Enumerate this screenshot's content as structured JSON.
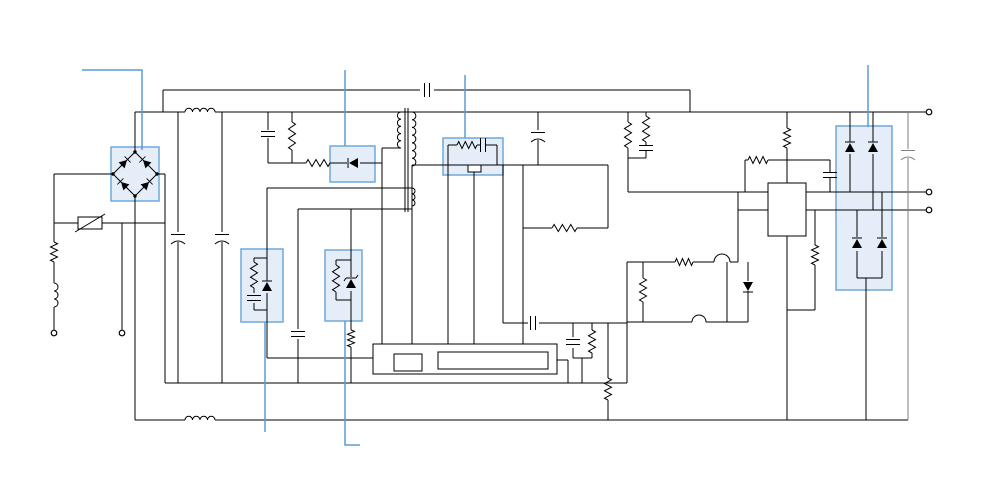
{
  "diagram": {
    "title": "switched-mode-power-supply-schematic",
    "canvas": {
      "width": 1000,
      "height": 500,
      "background": "#ffffff"
    },
    "colors": {
      "wire": "#000000",
      "highlight_fill": "#cfe0f2",
      "highlight_stroke": "#6fa8dc",
      "leader": "#5b9bd5",
      "secondary_wire": "#7f7f7f"
    },
    "highlights": [
      {
        "n": "bridge-rectifier-highlight",
        "x": 111,
        "y": 147,
        "w": 48,
        "h": 54
      },
      {
        "n": "clamp-diode-highlight",
        "x": 330,
        "y": 146,
        "w": 45,
        "h": 36
      },
      {
        "n": "shunt-network-1-highlight",
        "x": 241,
        "y": 249,
        "w": 42,
        "h": 73
      },
      {
        "n": "shunt-zener-highlight",
        "x": 325,
        "y": 250,
        "w": 37,
        "h": 71
      },
      {
        "n": "rc-clamp-highlight",
        "x": 443,
        "y": 138,
        "w": 60,
        "h": 37
      },
      {
        "n": "output-rectifier-highlight",
        "x": 836,
        "y": 126,
        "w": 56,
        "h": 164
      }
    ],
    "leaders": [
      {
        "n": "callout-bridge",
        "pts": [
          [
            82,
            70
          ],
          [
            142,
            70
          ],
          [
            142,
            150
          ]
        ]
      },
      {
        "n": "callout-clamp-diode",
        "pts": [
          [
            345,
            70
          ],
          [
            345,
            146
          ]
        ]
      },
      {
        "n": "callout-rc-clamp",
        "pts": [
          [
            465,
            75
          ],
          [
            465,
            138
          ]
        ]
      },
      {
        "n": "callout-output-rectifier",
        "pts": [
          [
            868,
            65
          ],
          [
            868,
            127
          ]
        ]
      },
      {
        "n": "callout-shunt-1",
        "pts": [
          [
            265,
            322
          ],
          [
            265,
            432
          ]
        ]
      },
      {
        "n": "callout-shunt-zener",
        "pts": [
          [
            345,
            321
          ],
          [
            345,
            445
          ],
          [
            360,
            445
          ]
        ]
      }
    ],
    "wires": [
      [
        163,
        90,
        420,
        90
      ],
      [
        434,
        90,
        690,
        90
      ],
      [
        163,
        90,
        163,
        112
      ],
      [
        690,
        90,
        690,
        112
      ],
      [
        135,
        112,
        185,
        112
      ],
      [
        215,
        112,
        926,
        112
      ],
      [
        135,
        112,
        135,
        152
      ],
      [
        135,
        196,
        135,
        420
      ],
      [
        113,
        174,
        54,
        174
      ],
      [
        54,
        174,
        54,
        242
      ],
      [
        54,
        262,
        54,
        283
      ],
      [
        54,
        307,
        54,
        330
      ],
      [
        157,
        174,
        165,
        174
      ],
      [
        165,
        174,
        165,
        383
      ],
      [
        54,
        223,
        78,
        223
      ],
      [
        102,
        223,
        165,
        223
      ],
      [
        122,
        223,
        122,
        330
      ],
      [
        165,
        383,
        627,
        383
      ],
      [
        135,
        420,
        185,
        420
      ],
      [
        215,
        420,
        908,
        420
      ],
      [
        178,
        112,
        178,
        232
      ],
      [
        178,
        242,
        178,
        383
      ],
      [
        222,
        112,
        222,
        232
      ],
      [
        222,
        242,
        222,
        383
      ],
      [
        268,
        112,
        268,
        130
      ],
      [
        268,
        138,
        268,
        163
      ],
      [
        292,
        112,
        292,
        122
      ],
      [
        292,
        150,
        292,
        163
      ],
      [
        268,
        163,
        292,
        163
      ],
      [
        292,
        163,
        306,
        163
      ],
      [
        330,
        163,
        347,
        163
      ],
      [
        360,
        163,
        382,
        163
      ],
      [
        382,
        148,
        382,
        344
      ],
      [
        382,
        148,
        401,
        148
      ],
      [
        412,
        188,
        267,
        188
      ],
      [
        412,
        206,
        412,
        209
      ],
      [
        298,
        209,
        412,
        209
      ],
      [
        267,
        188,
        267,
        281
      ],
      [
        267,
        293,
        267,
        322
      ],
      [
        267,
        322,
        267,
        358
      ],
      [
        267,
        358,
        373,
        358
      ],
      [
        267,
        258,
        254,
        258
      ],
      [
        254,
        258,
        254,
        262
      ],
      [
        254,
        288,
        254,
        293
      ],
      [
        254,
        303,
        254,
        310
      ],
      [
        254,
        310,
        267,
        310
      ],
      [
        351,
        209,
        351,
        277
      ],
      [
        351,
        291,
        351,
        330
      ],
      [
        351,
        347,
        351,
        383
      ],
      [
        351,
        260,
        336,
        260
      ],
      [
        336,
        260,
        336,
        265
      ],
      [
        336,
        292,
        336,
        300
      ],
      [
        336,
        300,
        351,
        300
      ],
      [
        298,
        209,
        298,
        329
      ],
      [
        298,
        339,
        298,
        383
      ],
      [
        412,
        165,
        608,
        165
      ],
      [
        412,
        165,
        412,
        344
      ],
      [
        448,
        145,
        457,
        145
      ],
      [
        477,
        145,
        480,
        145
      ],
      [
        486,
        145,
        497,
        145
      ],
      [
        448,
        145,
        448,
        165
      ],
      [
        497,
        145,
        497,
        165
      ],
      [
        448,
        165,
        448,
        354
      ],
      [
        474,
        172,
        474,
        354
      ],
      [
        503,
        165,
        503,
        323
      ],
      [
        523,
        165,
        523,
        354
      ],
      [
        538,
        112,
        538,
        130
      ],
      [
        538,
        140,
        538,
        165
      ],
      [
        608,
        165,
        608,
        228
      ],
      [
        577,
        228,
        608,
        228
      ],
      [
        523,
        228,
        552,
        228
      ],
      [
        503,
        323,
        528,
        323
      ],
      [
        539,
        323,
        627,
        323
      ],
      [
        573,
        323,
        573,
        337
      ],
      [
        573,
        348,
        573,
        358
      ],
      [
        592,
        323,
        592,
        330
      ],
      [
        592,
        353,
        592,
        358
      ],
      [
        573,
        358,
        592,
        358
      ],
      [
        582,
        358,
        582,
        383
      ],
      [
        608,
        323,
        608,
        378
      ],
      [
        608,
        400,
        608,
        420
      ],
      [
        422,
        362,
        438,
        362
      ],
      [
        548,
        360,
        568,
        360
      ],
      [
        568,
        360,
        568,
        383
      ],
      [
        628,
        112,
        628,
        122
      ],
      [
        628,
        148,
        628,
        192
      ],
      [
        646,
        112,
        646,
        116
      ],
      [
        646,
        142,
        646,
        145
      ],
      [
        646,
        151,
        646,
        158
      ],
      [
        628,
        158,
        646,
        158
      ],
      [
        628,
        192,
        768,
        192
      ],
      [
        806,
        192,
        926,
        192
      ],
      [
        738,
        210,
        768,
        210
      ],
      [
        806,
        210,
        926,
        210
      ],
      [
        738,
        192,
        738,
        262
      ],
      [
        787,
        112,
        787,
        128
      ],
      [
        787,
        148,
        787,
        183
      ],
      [
        745,
        160,
        748,
        160
      ],
      [
        745,
        160,
        745,
        192
      ],
      [
        768,
        160,
        830,
        160
      ],
      [
        830,
        160,
        830,
        172
      ],
      [
        830,
        178,
        830,
        192
      ],
      [
        627,
        262,
        675,
        262
      ],
      [
        693,
        262,
        714,
        262
      ],
      [
        730,
        262,
        738,
        262
      ],
      [
        627,
        262,
        627,
        383
      ],
      [
        627,
        322,
        692,
        322
      ],
      [
        706,
        322,
        748,
        322
      ],
      [
        727,
        262,
        727,
        322
      ],
      [
        748,
        262,
        748,
        281
      ],
      [
        748,
        291,
        748,
        322
      ],
      [
        643,
        262,
        643,
        278
      ],
      [
        643,
        302,
        643,
        322
      ],
      [
        787,
        236,
        787,
        420
      ],
      [
        815,
        210,
        815,
        245
      ],
      [
        815,
        265,
        815,
        310
      ],
      [
        787,
        310,
        815,
        310
      ],
      [
        850,
        112,
        850,
        142
      ],
      [
        850,
        154,
        850,
        192
      ],
      [
        873,
        112,
        873,
        142
      ],
      [
        873,
        154,
        873,
        210
      ],
      [
        857,
        210,
        857,
        237
      ],
      [
        857,
        251,
        857,
        278
      ],
      [
        882,
        192,
        882,
        237
      ],
      [
        882,
        251,
        882,
        278
      ],
      [
        857,
        278,
        882,
        278
      ],
      [
        866,
        278,
        866,
        420
      ]
    ],
    "gray_wires": [
      [
        908,
        112,
        908,
        149
      ],
      [
        908,
        158,
        908,
        420
      ]
    ],
    "components": [
      {
        "t": "bridge",
        "n": "bridge-rectifier",
        "cx": 135,
        "cy": 174,
        "r": 22
      },
      {
        "t": "xfmr",
        "n": "transformer",
        "core": [
          [
            405,
            108,
            405,
            212
          ],
          [
            408,
            108,
            408,
            212
          ]
        ],
        "coils": [
          {
            "x": 401,
            "y1": 112,
            "y2": 148,
            "sw": 0,
            "b": 5
          },
          {
            "x": 412,
            "y1": 112,
            "y2": 166,
            "sw": 1,
            "b": 7
          },
          {
            "x": 412,
            "y1": 188,
            "y2": 206,
            "sw": 1,
            "b": 3
          }
        ]
      },
      {
        "t": "var",
        "n": "varistor",
        "x": 90,
        "y": 223
      },
      {
        "t": "res",
        "n": "fusible-resistor",
        "x1": 54,
        "y1": 242,
        "x2": 54,
        "y2": 262
      },
      {
        "t": "res",
        "n": "bleeder-resistor",
        "x1": 292,
        "y1": 122,
        "x2": 292,
        "y2": 150
      },
      {
        "t": "res",
        "n": "clamp-resistor",
        "x1": 306,
        "y1": 163,
        "x2": 330,
        "y2": 163
      },
      {
        "t": "res",
        "n": "resistor",
        "x1": 254,
        "y1": 262,
        "x2": 254,
        "y2": 288
      },
      {
        "t": "res",
        "n": "resistor",
        "x1": 336,
        "y1": 265,
        "x2": 336,
        "y2": 292
      },
      {
        "t": "res",
        "n": "resistor",
        "x1": 351,
        "y1": 330,
        "x2": 351,
        "y2": 347
      },
      {
        "t": "res",
        "n": "snubber-resistor",
        "x1": 457,
        "y1": 145,
        "x2": 477,
        "y2": 145
      },
      {
        "t": "res",
        "n": "resistor",
        "x1": 628,
        "y1": 122,
        "x2": 628,
        "y2": 148
      },
      {
        "t": "res",
        "n": "resistor",
        "x1": 646,
        "y1": 116,
        "x2": 646,
        "y2": 142
      },
      {
        "t": "res",
        "n": "resistor",
        "x1": 787,
        "y1": 128,
        "x2": 787,
        "y2": 148
      },
      {
        "t": "res",
        "n": "resistor",
        "x1": 748,
        "y1": 160,
        "x2": 768,
        "y2": 160
      },
      {
        "t": "res",
        "n": "resistor",
        "x1": 675,
        "y1": 262,
        "x2": 693,
        "y2": 262
      },
      {
        "t": "res",
        "n": "resistor",
        "x1": 643,
        "y1": 278,
        "x2": 643,
        "y2": 302
      },
      {
        "t": "res",
        "n": "resistor",
        "x1": 815,
        "y1": 245,
        "x2": 815,
        "y2": 265
      },
      {
        "t": "res",
        "n": "resistor",
        "x1": 608,
        "y1": 378,
        "x2": 608,
        "y2": 400
      },
      {
        "t": "res",
        "n": "resistor",
        "x1": 592,
        "y1": 330,
        "x2": 592,
        "y2": 353
      },
      {
        "t": "res",
        "n": "sense-resistor",
        "x1": 552,
        "y1": 228,
        "x2": 577,
        "y2": 228
      },
      {
        "t": "cap",
        "n": "x-capacitor",
        "x": 268,
        "y": 134,
        "dir": "v",
        "pol": false
      },
      {
        "t": "cap",
        "n": "capacitor",
        "x": 646,
        "y": 148,
        "dir": "v",
        "pol": false
      },
      {
        "t": "cap",
        "n": "y-capacitor",
        "x": 427,
        "y": 90,
        "dir": "h",
        "pol": false
      },
      {
        "t": "cap",
        "n": "capacitor",
        "x": 533,
        "y": 323,
        "dir": "h",
        "pol": false
      },
      {
        "t": "cap",
        "n": "bulk-capacitor-1",
        "x": 178,
        "y": 237,
        "dir": "v",
        "pol": true
      },
      {
        "t": "cap",
        "n": "bulk-capacitor-2",
        "x": 222,
        "y": 237,
        "dir": "v",
        "pol": true
      },
      {
        "t": "cap",
        "n": "snubber-capacitor",
        "x": 483,
        "y": 145,
        "dir": "h",
        "pol": false
      },
      {
        "t": "cap",
        "n": "capacitor",
        "x": 254,
        "y": 298,
        "dir": "v",
        "pol": false
      },
      {
        "t": "cap",
        "n": "capacitor",
        "x": 298,
        "y": 334,
        "dir": "v",
        "pol": false
      },
      {
        "t": "cap",
        "n": "capacitor",
        "x": 573,
        "y": 342,
        "dir": "v",
        "pol": false
      },
      {
        "t": "cap",
        "n": "capacitor",
        "x": 830,
        "y": 175,
        "dir": "v",
        "pol": false
      },
      {
        "t": "cap",
        "n": "bias-capacitor",
        "x": 538,
        "y": 135,
        "dir": "v",
        "pol": true
      },
      {
        "t": "cap",
        "n": "output-capacitor",
        "x": 908,
        "y": 153,
        "dir": "v",
        "pol": true,
        "gray": true
      },
      {
        "t": "dio",
        "n": "clamp-diode",
        "x": 354,
        "y": 163,
        "rot": 180,
        "z": false
      },
      {
        "t": "dio",
        "n": "diode",
        "x": 267,
        "y": 287,
        "rot": -90,
        "z": false
      },
      {
        "t": "dio",
        "n": "zener-diode",
        "x": 351,
        "y": 284,
        "rot": -90,
        "z": true
      },
      {
        "t": "dio",
        "n": "output-diode-1",
        "x": 850,
        "y": 148,
        "rot": -90,
        "z": false
      },
      {
        "t": "dio",
        "n": "output-diode-2",
        "x": 873,
        "y": 148,
        "rot": -90,
        "z": false
      },
      {
        "t": "dio",
        "n": "output-diode-3",
        "x": 857,
        "y": 244,
        "rot": -90,
        "z": false
      },
      {
        "t": "dio",
        "n": "output-diode-4",
        "x": 882,
        "y": 244,
        "rot": -90,
        "z": false
      },
      {
        "t": "dio",
        "n": "diode",
        "x": 748,
        "y": 286,
        "rot": 90,
        "z": false
      },
      {
        "t": "ind",
        "n": "cm-choke-top",
        "x1": 185,
        "y1": 112,
        "x2": 215,
        "y2": 112,
        "b": 4,
        "sw": 1
      },
      {
        "t": "ind",
        "n": "cm-choke-bottom",
        "x1": 185,
        "y1": 420,
        "x2": 215,
        "y2": 420,
        "b": 4,
        "sw": 1
      },
      {
        "t": "ind",
        "n": "input-inductor",
        "x1": 54,
        "y1": 283,
        "x2": 54,
        "y2": 307,
        "b": 3,
        "sw": 1
      },
      {
        "t": "box",
        "n": "controller-ic-outline",
        "x": 373,
        "y": 344,
        "w": 184,
        "h": 30
      },
      {
        "t": "box",
        "n": "controller-ic-left-block",
        "x": 394,
        "y": 354,
        "w": 28,
        "h": 17
      },
      {
        "t": "box",
        "n": "controller-ic-main-block",
        "x": 438,
        "y": 352,
        "w": 110,
        "h": 17
      },
      {
        "t": "box",
        "n": "regulator-ic",
        "x": 768,
        "y": 183,
        "w": 38,
        "h": 53
      },
      {
        "t": "box",
        "n": "clamp-device",
        "x": 468,
        "y": 165,
        "w": 13,
        "h": 7
      },
      {
        "t": "bump",
        "n": "transistor-1",
        "x": 722,
        "y": 262,
        "r": 8
      },
      {
        "t": "bump",
        "n": "transistor-2",
        "x": 699,
        "y": 322,
        "r": 7
      }
    ],
    "terminals": [
      {
        "n": "input-terminal-line",
        "x": 54,
        "y": 333
      },
      {
        "n": "input-terminal-neutral",
        "x": 122,
        "y": 333
      },
      {
        "n": "output-terminal-positive",
        "x": 929,
        "y": 112
      },
      {
        "n": "output-terminal-mid-1",
        "x": 929,
        "y": 192
      },
      {
        "n": "output-terminal-mid-2",
        "x": 929,
        "y": 210
      }
    ]
  }
}
